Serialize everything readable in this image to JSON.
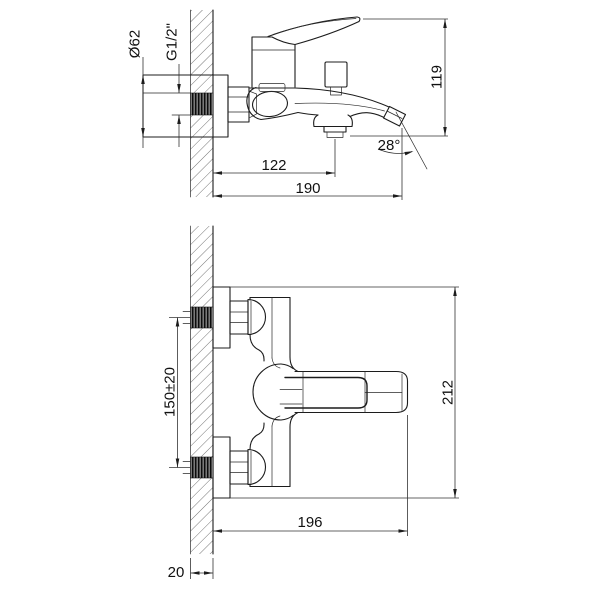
{
  "drawing": {
    "description": "bath-mixer-installation-drawing",
    "colors": {
      "line": "#1c1c1c",
      "background": "#ffffff"
    },
    "dimensions": {
      "side_view": {
        "flange_diameter": "Ø62",
        "thread_size": "G1/2\"",
        "height": "119",
        "spout_outlet_offset": "122",
        "spout_reach": "190",
        "spout_angle": "28°"
      },
      "front_view": {
        "inlet_spacing": "150±20",
        "body_length": "212",
        "overall_depth": "196",
        "wall_thickness": "20"
      }
    }
  }
}
